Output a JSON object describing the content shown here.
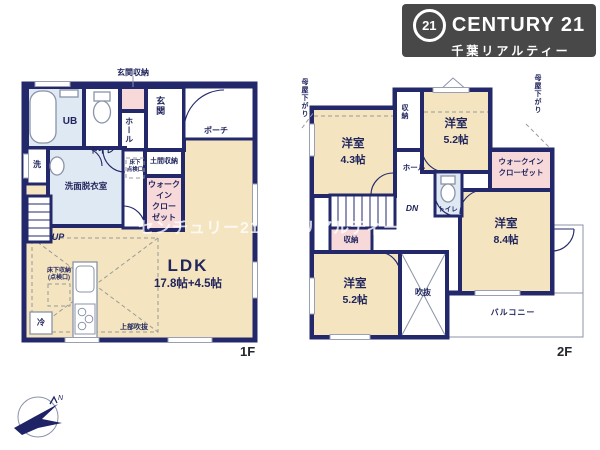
{
  "brand": {
    "logo_circle": "21",
    "logo_text": "CENTURY 21",
    "logo_subtext": "千葉リアルティー"
  },
  "watermark": "センチュリー21 千葉リアルティー",
  "compass": {
    "north_label": "N"
  },
  "colors": {
    "wall": "#23286b",
    "room_cream": "#f4e4c0",
    "room_blue": "#dfe9f4",
    "closet_pink": "#f7d9da",
    "logo_bg": "#484848",
    "watermark_text": "rgba(255,255,255,0.78)"
  },
  "floor1": {
    "tag": "1F",
    "genkan_shuno": "玄関収納",
    "ub": "UB",
    "toilet": "トイレ",
    "hall": "ホール",
    "genkan": "玄関",
    "porch": "ポーチ",
    "sen": "洗",
    "senmen": "洗面脱衣室",
    "yukashita_tenken_1": "床下",
    "yukashita_tenken_2": "点検口",
    "up": "UP",
    "doma_shuno": "土間収納",
    "wic_1": "ウォーク",
    "wic_2": "イン",
    "wic_3": "クロー",
    "wic_4": "ゼット",
    "ldk": "LDK",
    "ldk_size": "17.8帖+4.5帖",
    "yukashita_shuno_1": "床下収納",
    "yukashita_shuno_2": "(点検口)",
    "rei": "冷",
    "jobu_fukinuke": "上部吹抜"
  },
  "floor2": {
    "tag": "2F",
    "moya_left": "母屋下がり",
    "moya_right": "母屋下がり",
    "room43": "洋室",
    "room43_size": "4.3帖",
    "shuno_top": "収納",
    "room52tr": "洋室",
    "room52tr_size": "5.2帖",
    "wic_1": "ウォークイン",
    "wic_2": "クローゼット",
    "room84": "洋室",
    "room84_size": "8.4帖",
    "toilet": "トイレ",
    "hall": "ホール",
    "dn": "DN",
    "shuno_mid": "収納",
    "room52bl": "洋室",
    "room52bl_size": "5.2帖",
    "fukinuke": "吹抜",
    "balcony": "バルコニー"
  }
}
